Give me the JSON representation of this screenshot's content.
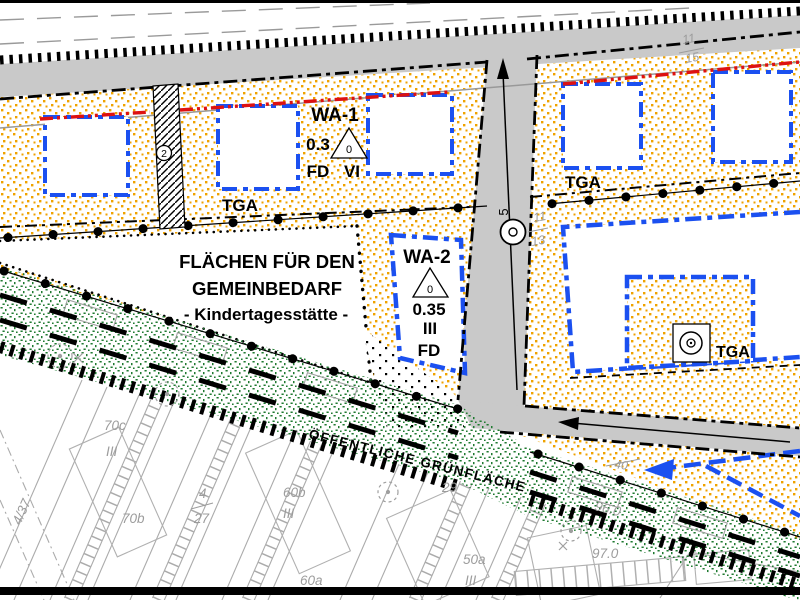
{
  "plan": {
    "zone_wa1": {
      "name": "WA-1",
      "grz": "0.3",
      "triangle_value": "0",
      "dach": "FD",
      "geschosse": "VI"
    },
    "zone_wa2": {
      "name": "WA-2",
      "triangle_value": "0",
      "grz": "0.35",
      "geschosse": "III",
      "dach": "FD"
    },
    "gemeinbedarf": {
      "line1": "FLÄCHEN FÜR DEN",
      "line2": "GEMEINBEDARF",
      "line3": "- Kindertagesstätte -"
    },
    "green_area_label": "ÖFFENTLICHE GRÜNFLÄCHE",
    "tga_west": "TGA",
    "tga_east_north": "TGA",
    "tga_east_south": "TGA",
    "circle_marker": "2",
    "street_number": "5",
    "house_numbers": {
      "west_upper": "11",
      "west_lower": "13",
      "north_upper": "11",
      "north_lower": "15"
    },
    "cadastre": {
      "p70c": "70c",
      "p70c_storeys": "III",
      "p70b": "70b",
      "p4_37": "4/37",
      "p4_27_top": "4",
      "p4_27_bottom": "27",
      "p60b": "60b",
      "p60b_storeys": "III",
      "p60a": "60a",
      "p29": "29",
      "p50a": "50a",
      "p50a_storeys": "III",
      "e97": "97.0",
      "e96": "96.0",
      "e40": "40"
    },
    "colors": {
      "wa_stipple": "#EFA200",
      "green_stipple": "#1F7A30",
      "baugrenze_blue": "#1B50F0",
      "baulinie_red": "#DD1111",
      "road_gray": "#C9C9C9",
      "cadastre_gray": "#A8A8A8"
    }
  }
}
